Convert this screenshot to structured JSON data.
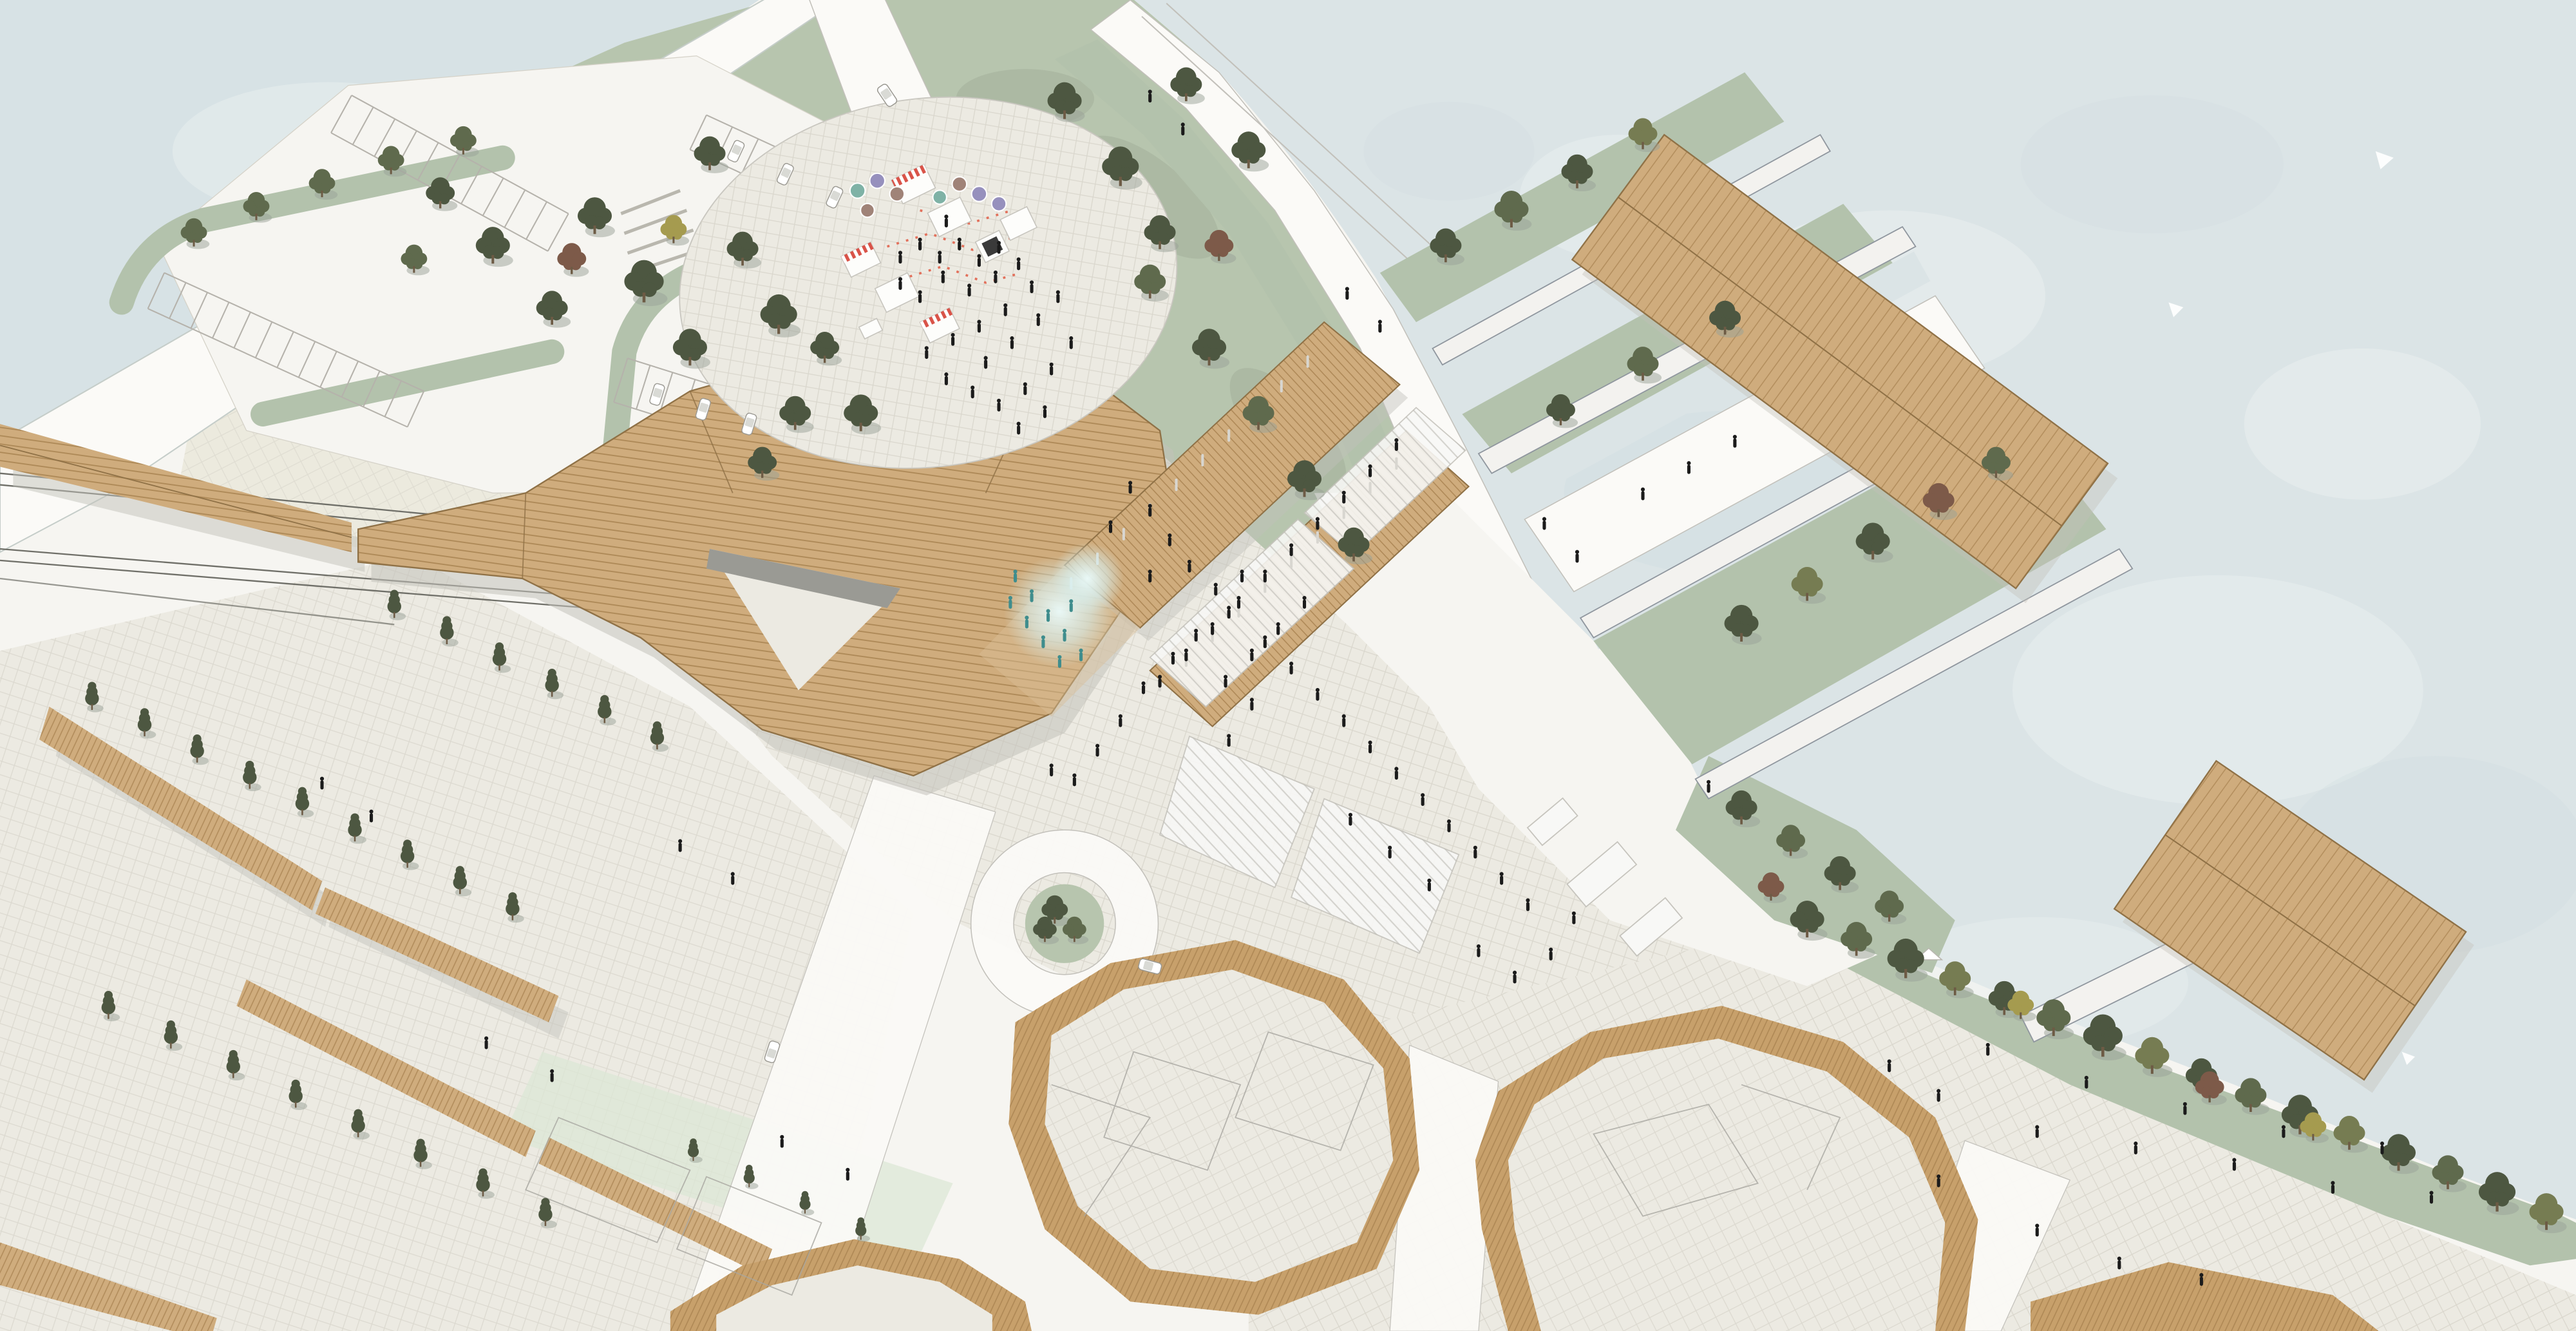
{
  "scene": {
    "type": "architectural-masterplan-aerial-rendering",
    "style": "watercolor axonometric site plan",
    "areas": [
      "sea-harbour",
      "pond",
      "park-lawn",
      "event-market-plaza",
      "parking-lots",
      "railway-tracks",
      "main-station-building",
      "market-street-canopies",
      "ferry-piers",
      "central-plaza",
      "fountain",
      "traffic-loop",
      "courtyard-housing-blocks",
      "linear-buildings",
      "waterfront-promenade",
      "shore-tree-row"
    ]
  },
  "colors": {
    "paper": "#f6f5f1",
    "sea": "#dbe4e6",
    "sea_light": "#e9efef",
    "sea_deep": "#cfdce0",
    "pond": "#d7e2e5",
    "lawn": "#b7c5ae",
    "lawn_shadow": "#9aa894",
    "green_strip": "#b3c2ac",
    "mint": "#dce7d6",
    "paving": "#efede6",
    "paving_line": "#d5d2c8",
    "plaza": "#eceae2",
    "road": "#fbfaf7",
    "road_edge": "#bdbab2",
    "roof_tan": "#cfac7d",
    "roof_tan_light": "#d9bf97",
    "roof_hatch": "#a07a48",
    "roof_edge": "#8f7146",
    "strip_tan": "#c7a06b",
    "pier_slab": "#f3f2ef",
    "pier_edge": "#8f969e",
    "white_roof": "#f8f8f6",
    "white_roof_edge": "#c6c4bd",
    "rail": "#6f6f68",
    "shadow": "#c2c1ba",
    "tree_dark": "#4d5741",
    "tree_mid": "#5f6a4d",
    "tree_olive": "#767c52",
    "tree_autumn": "#7d5a49",
    "tree_yellow": "#a59b4f",
    "people": "#1b1b1b",
    "people_mist": "#3f8d8d",
    "tent_red": "#d95348",
    "flag_garland": "#e2705b",
    "umbrella_purple": "#9690bd",
    "umbrella_teal": "#7fb2a6",
    "umbrella_mauve": "#a08378",
    "kiosk_dark": "#3a3a3a",
    "mist": "#d8f0f0"
  }
}
